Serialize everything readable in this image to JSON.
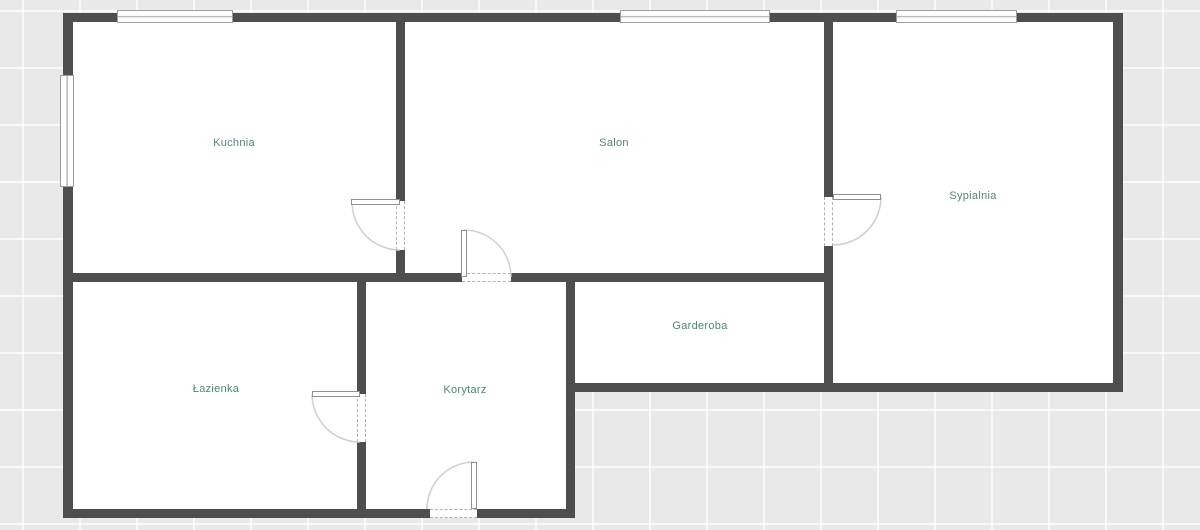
{
  "plan": {
    "rooms": {
      "kuchnia": {
        "label": "Kuchnia"
      },
      "salon": {
        "label": "Salon"
      },
      "sypialnia": {
        "label": "Sypialnia"
      },
      "garderoba": {
        "label": "Garderoba"
      },
      "lazienka": {
        "label": "Łazienka"
      },
      "korytarz": {
        "label": "Korytarz"
      }
    },
    "colors": {
      "wall": "#4e4e4e",
      "room_fill": "#ffffff",
      "background": "#e9e9e9",
      "grid_line": "#f7f7f7",
      "label_text": "#4f8579",
      "door_arc": "#cfcfcf"
    }
  }
}
